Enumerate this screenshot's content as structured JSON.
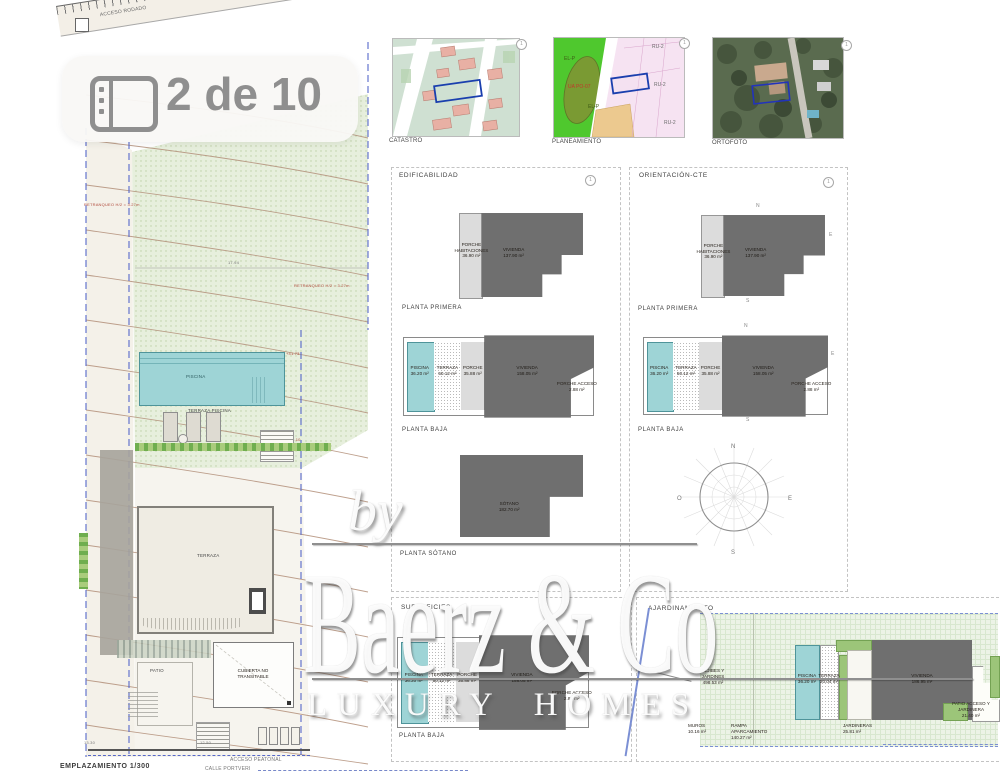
{
  "badge": {
    "icon": "gallery-icon",
    "label": "2 de 10"
  },
  "maps": {
    "catastro": {
      "label": "CATASTRO",
      "marker": "1"
    },
    "planeamiento": {
      "label": "PLANEAMIENTO",
      "marker": "1",
      "zones": {
        "elp": "EL-P",
        "elp2": "EL-P",
        "ru2a": "RU-2",
        "ru2b": "RU-2",
        "ru2c": "RU-2",
        "ua": "UA PO-07"
      }
    },
    "ortofoto": {
      "label": "ORTOFOTO",
      "marker": "1"
    }
  },
  "siteplan": {
    "title": "EMPLAZAMIENTO 1/300",
    "road_access": "ACCESO RODADO",
    "road_name": "CALLE TORRENT",
    "setback_left": "RETRANQUEO H/2 = 3.27m",
    "setback_right": "RETRANQUEO H/2 = 3.27m",
    "dim_top": "17.94",
    "dim_bottom_left": "13.30",
    "dim_bottom": "12.50",
    "level_pool": "+41.73",
    "level_terrace": "+40.10",
    "pool_label": "PISCINA",
    "pool_terrace_label": "TERRAZA PISCINA",
    "terrace_label": "TERRAZA",
    "patio_label": "PATIO",
    "roof_label_1": "CUBIERTA NO",
    "roof_label_2": "TRANSITABLE",
    "pedestrian_access": "ACCESO PEATONAL",
    "street_bottom": "CALLE PORTVERI"
  },
  "panels": {
    "edificabilidad": {
      "title": "EDIFICABILIDAD",
      "marker": "1"
    },
    "orientacion": {
      "title": "ORIENTACIÓN-CTE",
      "marker": "1"
    },
    "superficies": {
      "title": "SUPERFICIES"
    },
    "ajardinamiento": {
      "title": "AJARDINAMIENTO"
    }
  },
  "plans": {
    "planta_primera": {
      "label": "PLANTA PRIMERA",
      "porche": {
        "l1": "PORCHE",
        "l2": "HABITACIONES",
        "area": "36.90 m²"
      },
      "vivienda": {
        "l1": "VIVIENDA",
        "area": "137.90 m²"
      }
    },
    "planta_baja": {
      "label": "PLANTA BAJA",
      "piscina": {
        "l1": "PISCINA",
        "area": "36.20 m²"
      },
      "terraza": {
        "l1": "TERRAZA",
        "area": "50.12 m²"
      },
      "porche": {
        "l1": "PORCHE",
        "area": "35.88 m²"
      },
      "vivienda": {
        "l1": "VIVIENDA",
        "area": "158.05 m²"
      },
      "porche_acceso": {
        "l1": "PORCHE ACCESO",
        "area": "2.88 m²"
      }
    },
    "planta_sotano": {
      "label": "PLANTA SÓTANO",
      "sotano": {
        "l1": "SÓTANO",
        "area": "182.70 m²"
      }
    }
  },
  "orientation_letters": {
    "n": "N",
    "s": "S",
    "e": "E",
    "o": "O"
  },
  "ajardinamiento": {
    "aljibes": {
      "l1": "ALJIBES Y JARDINES",
      "area": "498.53 m²"
    },
    "piscina": {
      "l1": "PISCINA",
      "area": "36.20 m²"
    },
    "terraza": {
      "l1": "TERRAZA",
      "area": "20.04 m²"
    },
    "vivienda": {
      "l1": "VIVIENDA",
      "area": "186.95 m²"
    },
    "patio": {
      "l1": "PATIO ACCESO Y JARDINERA",
      "area": "21.40 m²"
    },
    "muros": {
      "l1": "MUROS",
      "area": "10.16 m²"
    },
    "rampa": {
      "l1": "RAMPA APARCAMIENTO",
      "area": "140.27 m²"
    },
    "jardineras": {
      "l1": "JARDINERAS",
      "area": "25.81 m²"
    }
  },
  "watermark": {
    "by": "by",
    "brand": "Baerz & Co",
    "tagline": "LUXURY HOMES"
  },
  "colors": {
    "pool_teal": "#9ed4d6",
    "built_dark": "#6f6f6f",
    "porch_gray": "#dcdcdc",
    "hedge_green": "#6fae4f",
    "boundary_blue": "#5668c9",
    "contour_brown": "#b3907a"
  }
}
